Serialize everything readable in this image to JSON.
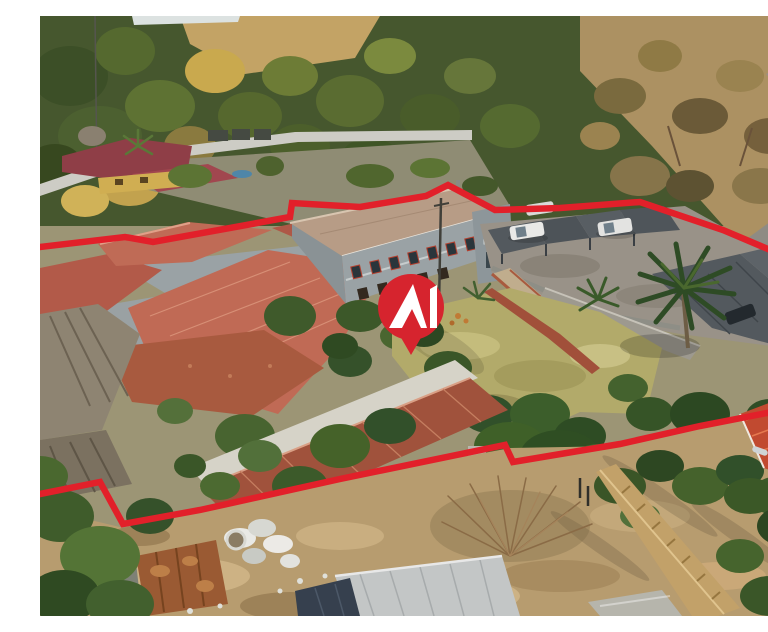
{
  "meta": {
    "kind": "aerial-property-photograph",
    "description": "Aerial drone photograph of a suburban property in dry winter bushveld: a complex of terracotta-tiled roofs and a double-storey main house, thatched lapa, brick courtyards, a shaded parking area with grey carports and white cars, a tall palm tree, dry lawn gardens, a construction yard with a rusty shed and building materials, neighbouring red-roofed houses, and a road along the top right. A red property-boundary outline is drawn over the photo and a red brand map-pin with a white A monogram sits at the centre."
  },
  "palette": {
    "boundary_red": "#e2202a",
    "pin_red": "#d6242e",
    "logo_white": "#ffffff",
    "veg_green_dark": "#46572e",
    "dry_grass": "#c3a365",
    "bushveld_tan": "#ac9162",
    "road_grey": "#8e8b84",
    "sky": "#dce2e1",
    "white_wall": "#cdccc5",
    "roof_terracotta": "#bf6b56",
    "roof_terracotta2": "#b25a49",
    "roof_darkred": "#8f3e47",
    "main_roof": "#b79c86",
    "wall_grey": "#9aa2a5",
    "window_red": "#b2402f",
    "thatch": "#8e8472",
    "brick_paving": "#a85a3f",
    "parking_grey": "#999288",
    "carport_grey": "#53595e",
    "car_white": "#e9e9e7",
    "lawn_dry": "#b2aa6a",
    "paving_tan": "#c0ad8d",
    "roof_brown": "#a0523c",
    "dirt": "#b79c6f",
    "rust": "#9a5a33",
    "precast": "#c2a169",
    "roof_bright": "#c14a30",
    "palm_green": "#2e4b25",
    "pool_blue": "#4f86a8"
  },
  "overlay": {
    "boundary_stroke_width": "6.5",
    "boundary_top_points": "0,231 85,221 113,226 250,201 252,187 320,191 386,180 408,169 455,194 520,192 600,186 683,214 768,250",
    "boundary_bottom_points": "0,478 60,466 83,508 160,494 300,463 465,429 473,446 580,428 660,410 768,389",
    "marker": {
      "cx": "371",
      "cy": "291",
      "r": "33",
      "tail_points": "356,313 386,313 371,339",
      "brand_monogram": "AI",
      "logo_a_outer": "349,312 373,268 387,312",
      "logo_a_notch": "362,312 372,293 381,312",
      "logo_bar": "390,273 397,269 397,312 390,312"
    }
  },
  "scene": {
    "regions": [
      {
        "name": "treeline-north",
        "summary": "dense green and autumn-yellow trees with a dry grass hillside and a sliver of pale sky"
      },
      {
        "name": "bushveld-northeast",
        "summary": "dry tan bushveld with bare winter trees beside a grey road"
      },
      {
        "name": "neighbour-house-northwest",
        "summary": "yellow-walled house with dark red roofs, small pool, palm and white boundary wall with garage doors"
      },
      {
        "name": "subject-villa-roofs",
        "summary": "cluster of salmon terracotta tiled roofs with grey walls and brick courtyard"
      },
      {
        "name": "main-double-storey-house",
        "summary": "long tan-roofed double storey with red-framed balcony windows and grey tower"
      },
      {
        "name": "thatched-lapa",
        "summary": "grey-brown thatched roofs at the lower left of the property"
      },
      {
        "name": "parking-carports",
        "summary": "grey shade-net carports with parked white cars on a concrete lot"
      },
      {
        "name": "tall-palm-tree",
        "summary": "large dark-green palm inside the eastern garden"
      },
      {
        "name": "dry-lawn-garden",
        "summary": "yellow-green winter lawn with brick paths, shrubs and small palms"
      },
      {
        "name": "garage-outbuilding",
        "summary": "long brown tiled garage roof with white walls running diagonally"
      },
      {
        "name": "construction-yard",
        "summary": "bare dirt yard with rusty corrugated shed, white sacks and building rubble"
      },
      {
        "name": "dry-scrub",
        "summary": "leafless brown scrub bush in the lower middle"
      },
      {
        "name": "precast-wall",
        "summary": "tan precast panel wall running to the lower right"
      },
      {
        "name": "neighbour-house-southeast",
        "summary": "bright red tiled neighbouring roof among green trees"
      },
      {
        "name": "new-roof-under-construction",
        "summary": "new grey sheet-metal roof at the bottom edge"
      }
    ]
  }
}
